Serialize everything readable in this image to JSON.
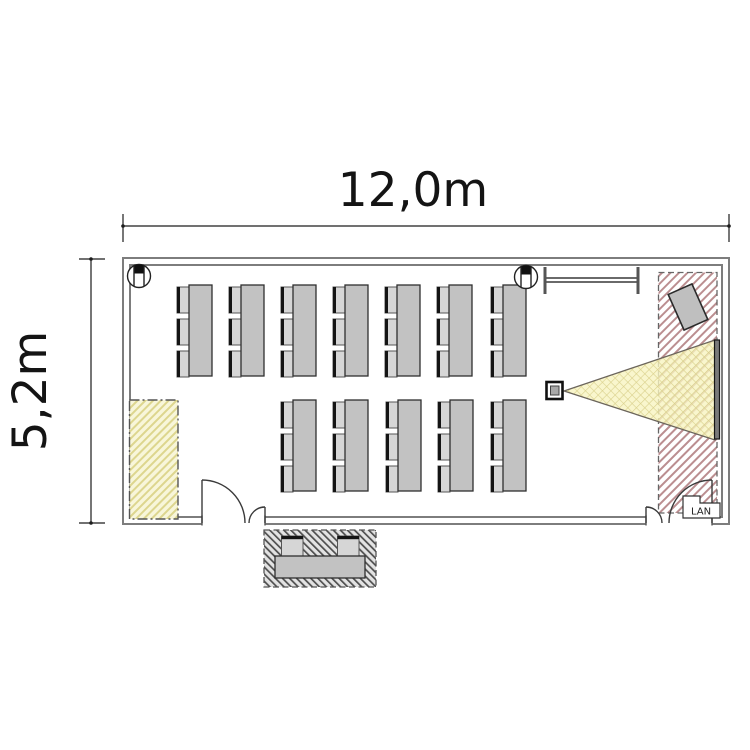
{
  "dimensions": {
    "width": "12,0m",
    "height": "5,2m"
  },
  "labels": {
    "lan": "LAN"
  },
  "room": {
    "desk_rows": [
      {
        "desks": 7,
        "chairs_per_desk": 3
      },
      {
        "desks": 5,
        "chairs_per_desk": 3
      }
    ],
    "reception_chairs": 2,
    "equipment": [
      "projector",
      "projection-screen",
      "whiteboard",
      "flipchart",
      "wall-speakers",
      "reception-desk"
    ]
  },
  "colors": {
    "wall": "#7d7d7d",
    "desk": "#c2c2c2",
    "chair": "#d6d6d6",
    "beam_fill": "#f6f1bd",
    "presenter_hatch": "#bb8e90",
    "storage_hatch": "#ddd68e",
    "outside_hatch": "#4e4e4e",
    "screen": "#7a7a7a"
  }
}
